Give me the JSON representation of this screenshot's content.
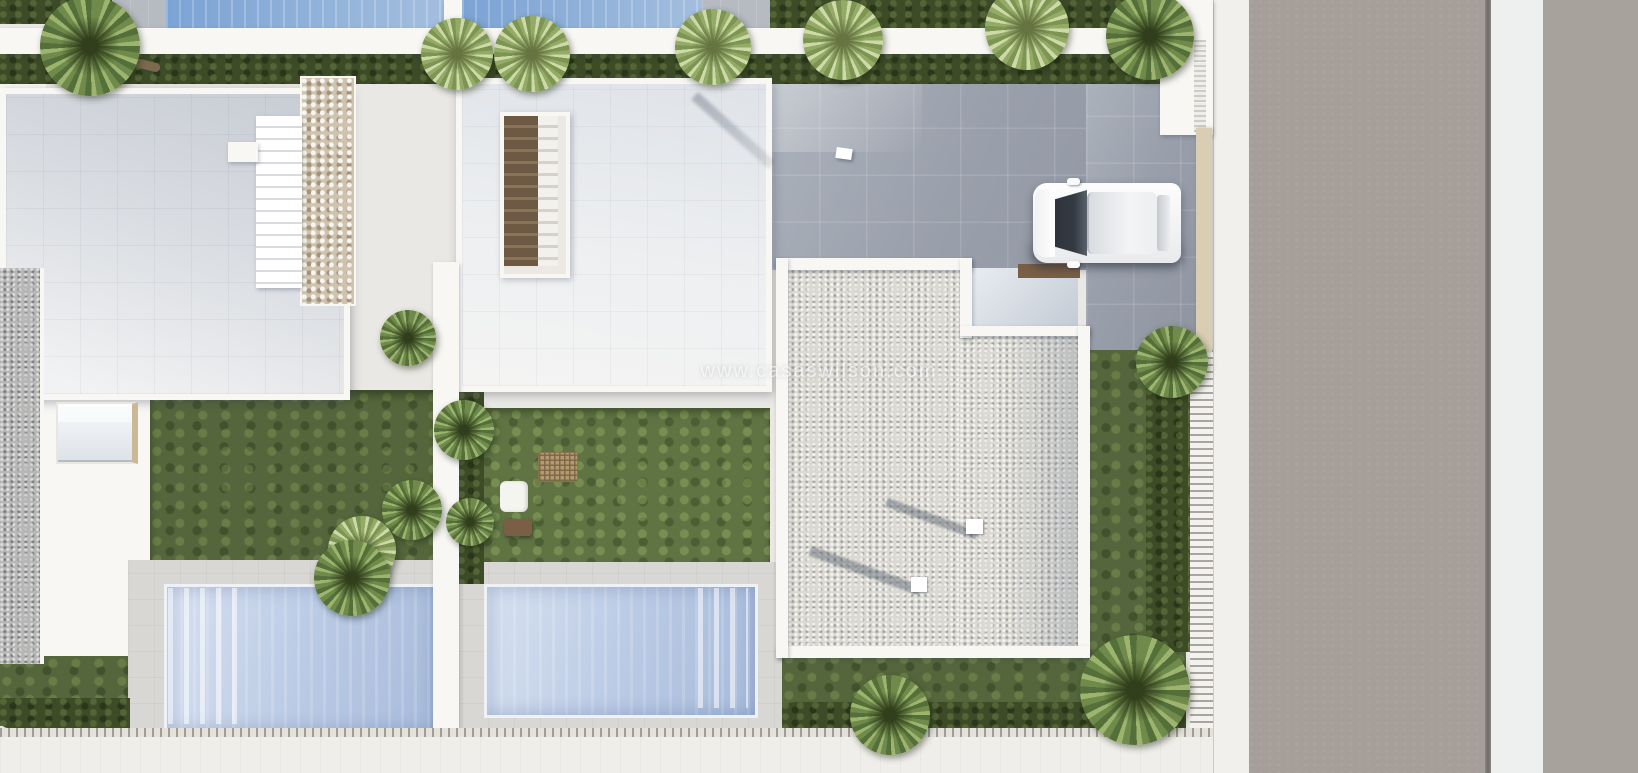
{
  "watermark": {
    "text": "www.casaswilson.com"
  },
  "palette": {
    "base": "#eae8e4",
    "wall": "#f8f7f4",
    "roof1_top": "#c7cbd3",
    "roof1_bottom": "#f1f2f3",
    "roof2_top": "#dfe2e7",
    "roof2_bottom": "#f4f4f3",
    "hedge": "#3d4b27",
    "lawn": "#55663c",
    "lawn_light": "#5f7343",
    "gravel": "#dbd9d1",
    "gravel_dark": "#b7b7b6",
    "stone": "#cfc3ad",
    "deck": "#d8d7d3",
    "pool": "#b9c9e4",
    "pool_edge": "#eef1f5",
    "pool_top": "#7ba3d4",
    "driveway": "#9aa0ab",
    "road": "#a59e99",
    "road2": "#a8a29d",
    "sidewalk": "#f2f0ec",
    "median": "#edf0ee",
    "tan": "#d9cdb4",
    "wood": "#7a5f46",
    "wood_light": "#b49a6e",
    "car": "#fdfdfd",
    "glass": "#343a42"
  },
  "scene": {
    "type": "aerial-3d-architectural-render",
    "objects": [
      "villa-roof-left",
      "villa-roof-middle",
      "gravel-roof-right",
      "stone-feature-wall",
      "staircase-left",
      "staircase-middle",
      "skylight",
      "swimming-pool-left",
      "swimming-pool-middle",
      "neighbor-pool-left",
      "neighbor-pool-right",
      "garden-lawns",
      "hedges",
      "palm-trees",
      "sun-lounger",
      "pergola-table",
      "side-table",
      "garden-armchair",
      "white-car",
      "driveway",
      "entry-terrace",
      "chimney-blocks",
      "boundary-fence",
      "sidewalk",
      "road"
    ]
  }
}
